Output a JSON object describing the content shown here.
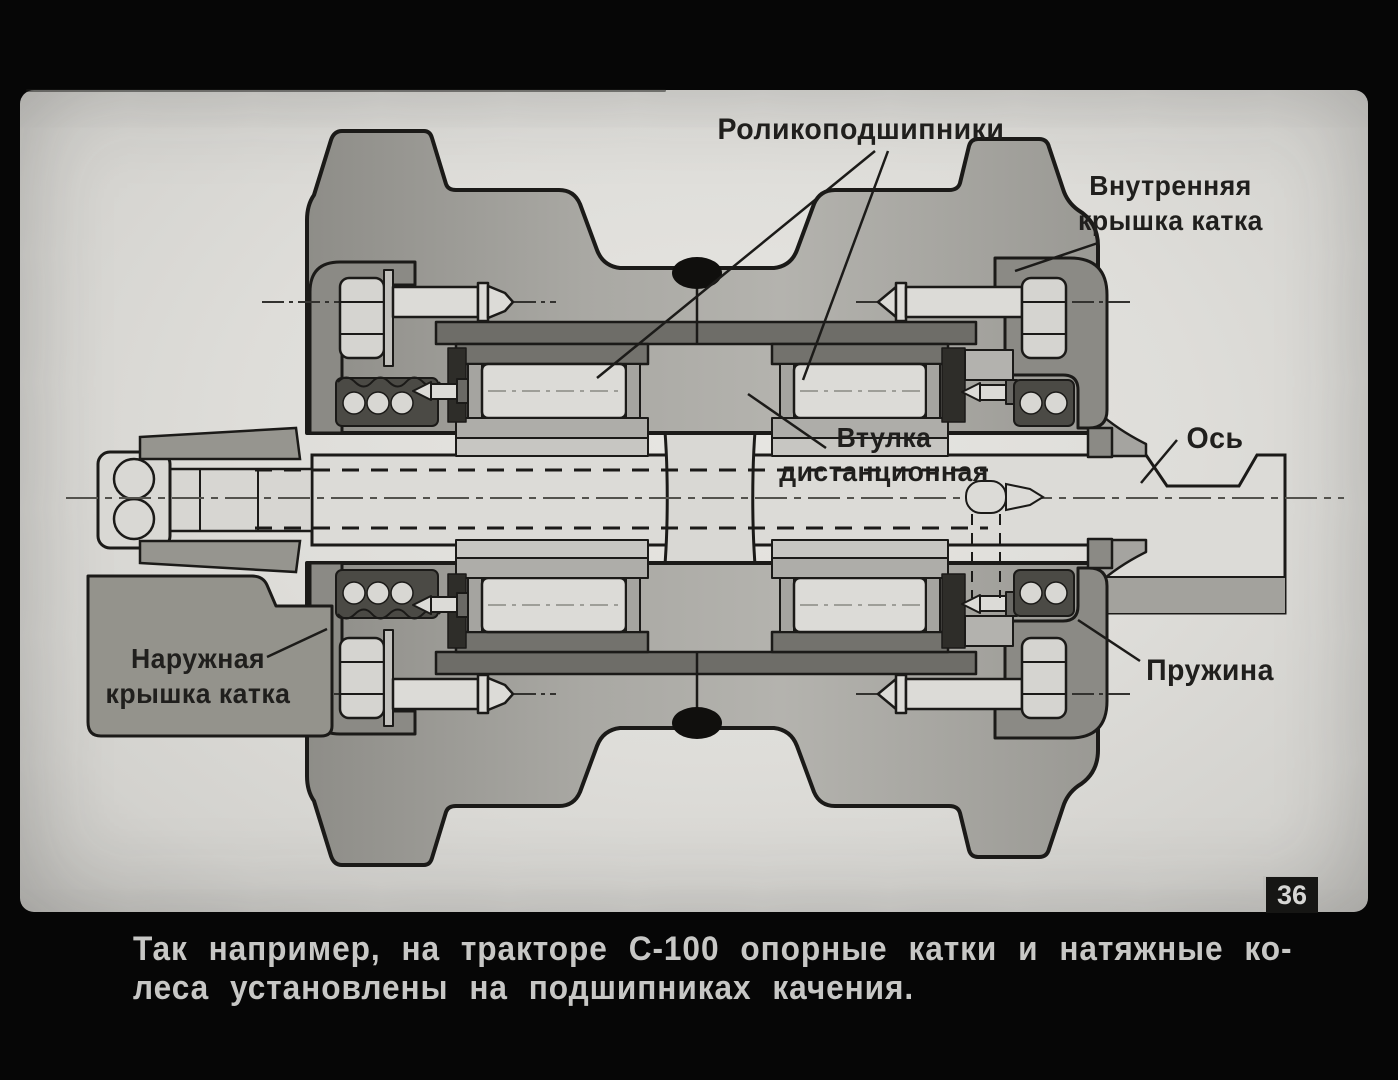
{
  "slide": {
    "number": "36",
    "diagram_labels": {
      "roller_bearings": "Роликоподшипники",
      "inner_cover_line1": "Внутренняя",
      "inner_cover_line2": "крышка катка",
      "spacer_sleeve_line1": "Втулка",
      "spacer_sleeve_line2": "дистанционная",
      "axle": "Ось",
      "outer_cover_line1": "Наружная",
      "outer_cover_line2": "крышка катка",
      "spring": "Пружина"
    },
    "caption": {
      "line1": "Так например, на тракторе С-100 опорные катки и натяжные ко-",
      "line2": "леса установлены на подшипниках качения."
    },
    "colors": {
      "film_black": "#060606",
      "slide_background": "#deddd9",
      "ink": "#1b1a18",
      "caption_text": "#c7c7c5"
    }
  }
}
